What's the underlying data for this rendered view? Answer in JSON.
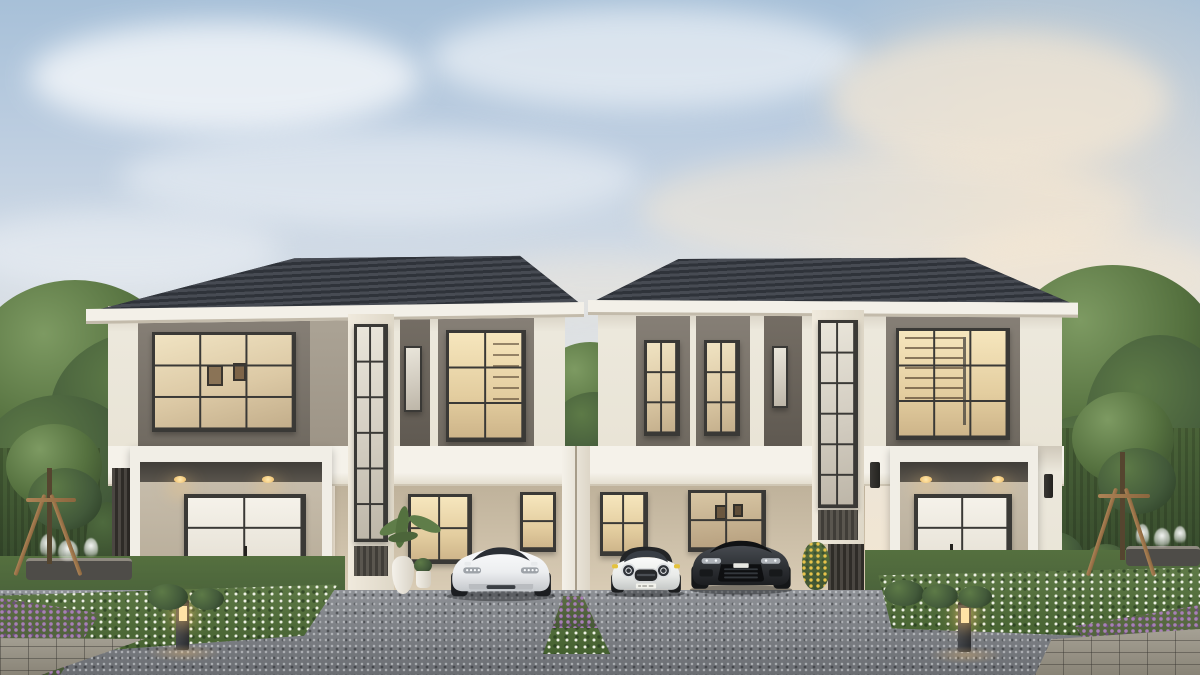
{
  "scene": {
    "type": "architectural exterior rendering",
    "description": "Dusk rendering of twin modern two-story houses with dark hipped tile roofs, cream walls and taupe accent panels, joined by a shared single-story carport band. A white electric sports sedan, a white mini hatchback with black roof and yellow mirror caps, and a dark gray luxury SUV are parked on a gray aggregate driveway. Landscaped yards flank both sides with canopy trees, young staked trees, clipped hedges, white wildflower beds, purple flower patches, small splashing fountains and glowing bollard path lamps.",
    "time_of_day": "late afternoon dusk with warm interior lighting",
    "sky": {
      "top_color": "#a7c0d8",
      "horizon_color": "#f0e4d0",
      "clouds": "soft scattered, warm-tinted toward the right"
    },
    "houses": [
      {
        "id": "left-house",
        "stories": 2,
        "roof": {
          "style": "hipped",
          "material": "dark concrete tile",
          "color": "#363a40"
        },
        "facade_colors": {
          "wall": "#ece8dc",
          "accent_panel": "#78726a",
          "trim": "#f3f0e8",
          "window_frames": "#3a3936"
        },
        "features": [
          "gridded upper window with framed pictures visible inside",
          "greige infill panel",
          "double-height stair window with louver spandrel",
          "narrow slit window",
          "lit upper window with shelving",
          "entry porch with canopy downlights",
          "glazed entry door",
          "vertical slat screen",
          "carport with warm lit windows"
        ]
      },
      {
        "id": "right-house",
        "stories": 2,
        "roof": {
          "style": "hipped",
          "material": "dark concrete tile",
          "color": "#363a40"
        },
        "facade_colors": {
          "wall": "#ece8dc",
          "accent_panel": "#78726a",
          "trim": "#f3f0e8",
          "window_frames": "#3a3936"
        },
        "features": [
          "vertical fin striped facade with twin tall windows",
          "narrow slit window",
          "double-height stair window with louver spandrel",
          "library window with bookshelves visible",
          "two dark wall sconces",
          "entry porch with canopy downlights",
          "bright glazed entry door",
          "vertical slat gate",
          "carport"
        ]
      }
    ],
    "carport": {
      "shared_band_color": "#f4f1e9",
      "wall_color": "#cfc3ac",
      "divider": "white twin column between the two driveways"
    },
    "vehicles": [
      {
        "id": "white-sports-sedan",
        "body_color": "#f2f3f5",
        "details": "low wide stance, four-dot LED headlights, dark windshield"
      },
      {
        "id": "white-mini-hatchback",
        "body_color": "#f2f3f2",
        "roof_color": "#232527",
        "mirror_caps": "#e4c23c",
        "details": "round LED ring headlights, chrome-rimmed grille, front license plate visible but illegible"
      },
      {
        "id": "dark-gray-suv",
        "body_color": "#2c2f33",
        "details": "sleek headlights, large dark grille with slats"
      }
    ],
    "landscape": {
      "driveway": "gray exposed-aggregate concrete",
      "beds": [
        "white wildflower bed left",
        "white wildflower bed right",
        "purple flower patches at both bottom corners",
        "center divider strip with purple flowers and grass"
      ],
      "trees": [
        "large canopy trees on both outer edges",
        "young staked trees with timber tripod supports on each lawn",
        "tree crown visible in the gap between the houses"
      ],
      "hedges": "tall clipped hedge walls with cone and ball shrubs",
      "fountains": [
        "small splashing fountain on dark stone basin, left",
        "small splashing fountain on dark stone basin, right"
      ],
      "path_lights": [
        "glowing bollard lamp left",
        "glowing bollard lamp right"
      ],
      "planters": [
        "tropical plant with white vase planters at left carport corner",
        "shrub with yellow blooms beside right carport",
        "round shrubs fronting both porches"
      ]
    },
    "palette": {
      "roof": "#363a40",
      "wall_cream": "#ece8dc",
      "panel_taupe": "#78726a",
      "glass_warm": "#e8d7b4",
      "driveway": "#7d8085",
      "grass": "#55703f",
      "hedge": "#3c5434",
      "flower_white": "#f4f6ec",
      "flower_purple": "#9a76a8",
      "timber": "#a37b4f",
      "lamp_glow": "#ffd98f"
    }
  }
}
